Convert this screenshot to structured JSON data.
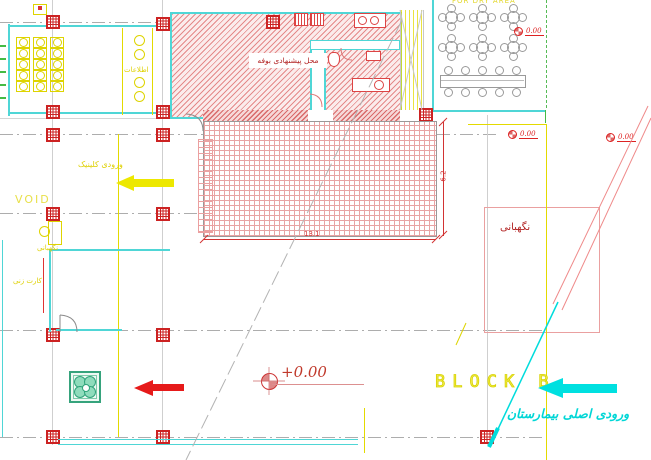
{
  "drawing": {
    "labels": {
      "buffet": "محل پیشنهادی بوفه",
      "information_desk": "اطلاعات",
      "clinic_entrance": "ورودی کلینیک",
      "void_space": "VOID",
      "guard_room_left": "نگهبانی",
      "time_card": "کارت زنی",
      "guard_room_right": "نگهبانی",
      "block": "BLOCK B",
      "hospital_main_entrance": "ورودی اصلی بیمارستان",
      "top_note": "FOR DRY AREA"
    },
    "elevation": {
      "main": "+0.00",
      "marker_top_right": "0.00",
      "marker_mid_left": "0.00",
      "marker_mid_right": "0.00"
    },
    "dimensions": {
      "terrace_width": "13.1",
      "terrace_depth": "6.2"
    },
    "furniture": {
      "waiting_chair_rows": 5,
      "waiting_chair_cols": 3,
      "round_table_rows": 2,
      "round_table_cols": 3,
      "long_table_chairs_per_side": 5,
      "counter_stools": 4
    },
    "colors": {
      "hatch_red": "#e48a8a",
      "column_red": "#cc2222",
      "wall_cyan": "#4fd6d6",
      "annotation_yellow": "#e3da00",
      "dimension_red": "#d23333",
      "arrow_red": "#e61a1a",
      "arrow_cyan": "#00e0e0",
      "planter_green": "#36a37c",
      "label_dark_red": "#b22222"
    }
  }
}
